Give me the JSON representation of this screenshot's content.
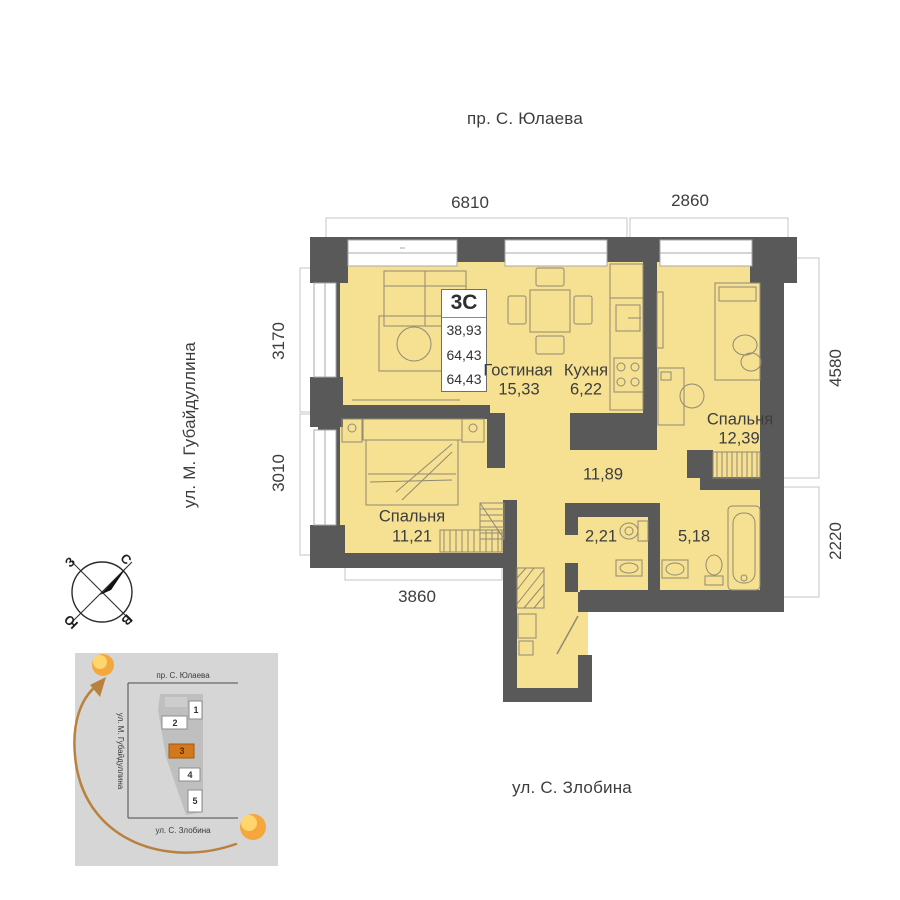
{
  "streets": {
    "top": "пр. С. Юлаева",
    "left": "ул. М. Губайдуллина",
    "bottom": "ул. С. Злобина"
  },
  "plan": {
    "type_label": "3С",
    "areas": [
      "38,93",
      "64,43",
      "64,43"
    ],
    "rooms": {
      "living": {
        "name": "Гостиная",
        "area": "15,33"
      },
      "kitchen": {
        "name": "Кухня",
        "area": "6,22"
      },
      "bedroom_right": {
        "name": "Спальня",
        "area": "12,39"
      },
      "bedroom_left": {
        "name": "Спальня",
        "area": "11,21"
      },
      "hallway": {
        "area": "11,89"
      },
      "wc": {
        "area": "2,21"
      },
      "bathroom": {
        "area": "5,18"
      }
    },
    "dimensions": {
      "top_left": "6810",
      "top_right": "2860",
      "left_upper": "3170",
      "left_lower": "3010",
      "right_upper": "4580",
      "right_lower": "2220",
      "bottom": "3860"
    }
  },
  "compass": {
    "north": "С",
    "south": "Ю",
    "west": "З",
    "east": "В"
  },
  "minimap": {
    "street_top": "пр. С. Юлаева",
    "street_left": "ул. М. Губайдуллина",
    "street_bottom": "ул. С. Злобина",
    "blocks": [
      {
        "label": "1"
      },
      {
        "label": "2"
      },
      {
        "label": "3",
        "highlighted": true
      },
      {
        "label": "4"
      },
      {
        "label": "5"
      }
    ]
  },
  "colors": {
    "room_fill": "#F6E092",
    "wall": "#595959",
    "highlight": "#D4781B",
    "sun": "#F3A73C",
    "sun_inner": "#FFD56E",
    "arrow": "#B9813E"
  }
}
